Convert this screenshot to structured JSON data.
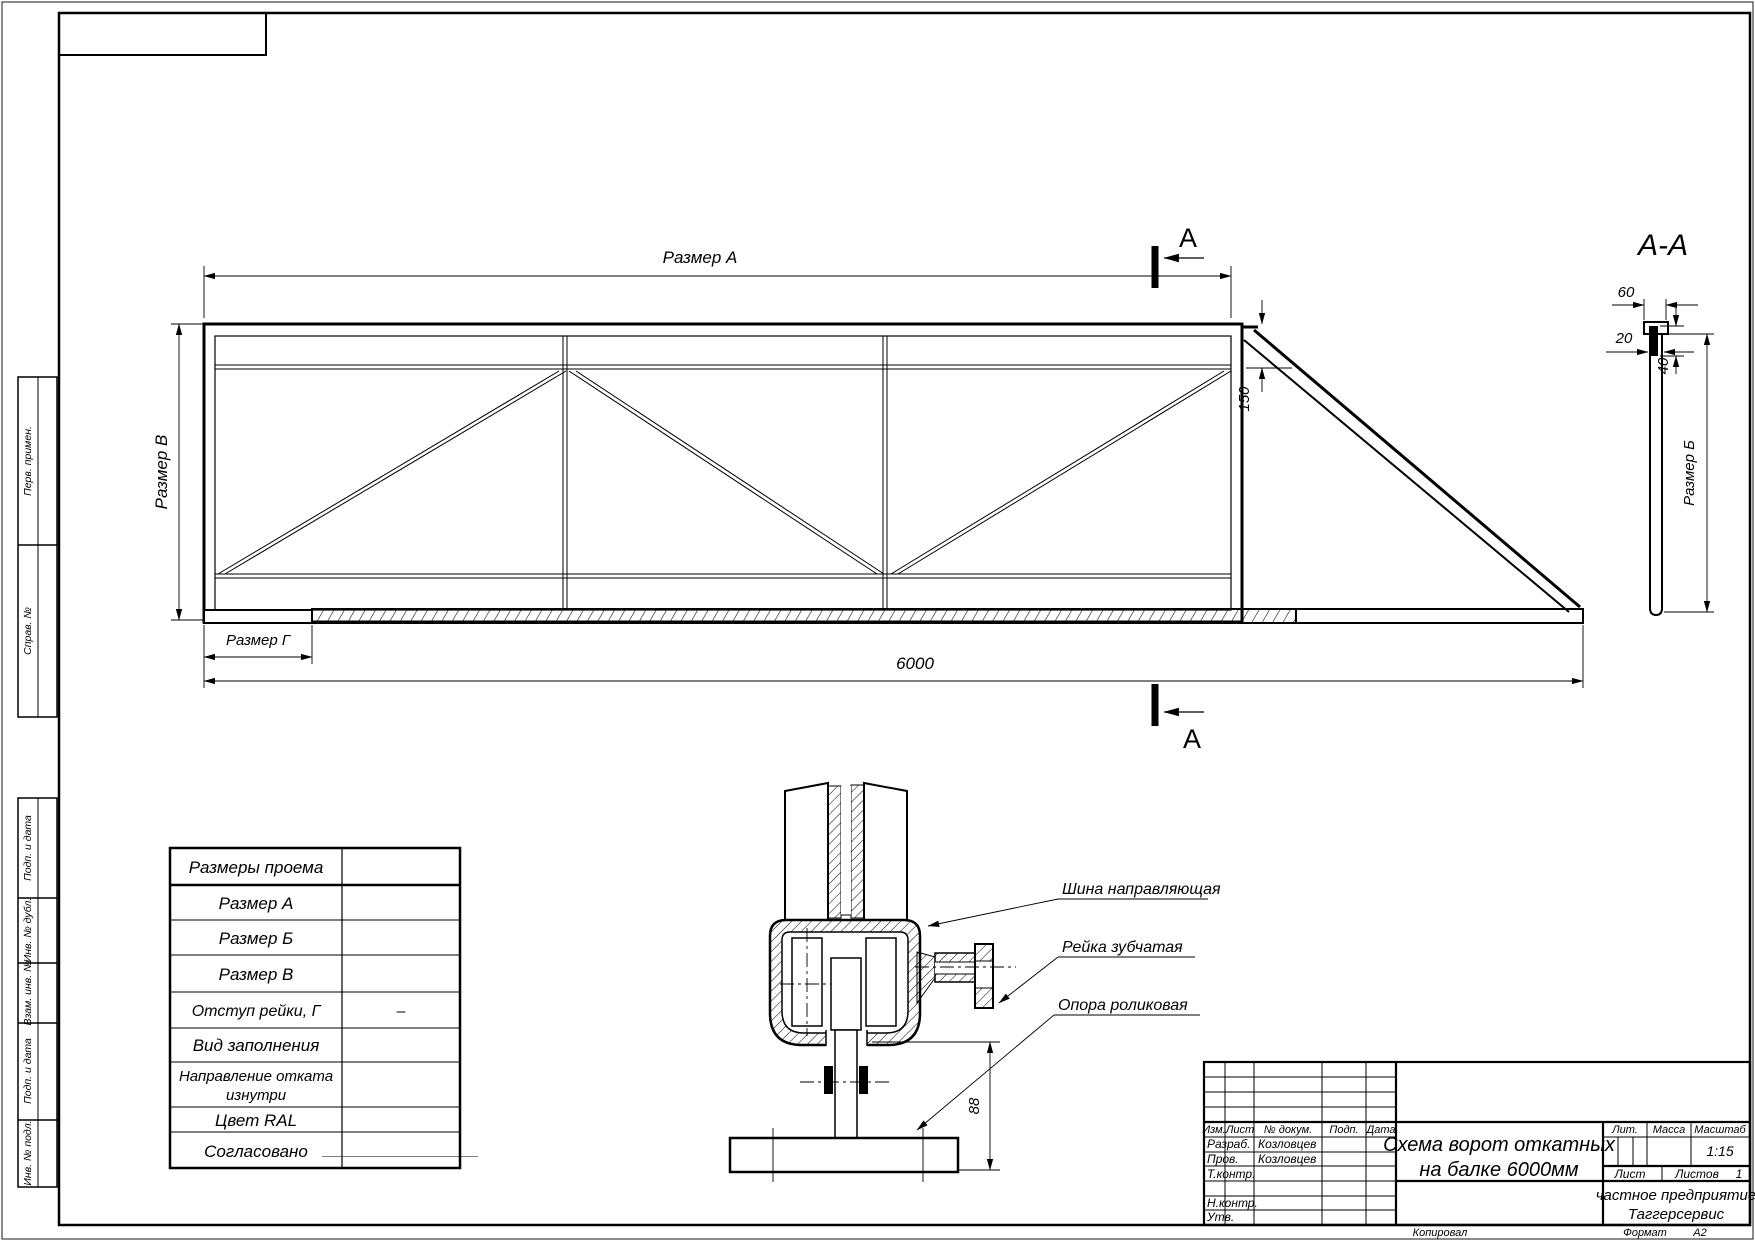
{
  "gate_view": {
    "dim_a": "Размер А",
    "dim_v": "Размер В",
    "dim_g": "Размер Г",
    "dim_length": "6000",
    "dim_150": "150",
    "section_letter": "А",
    "section_letter_bottom": "А"
  },
  "section_view": {
    "title": "А-А",
    "dim_60": "60",
    "dim_20": "20",
    "dim_40": "40",
    "dim_b": "Размер Б"
  },
  "detail_view": {
    "label_shina": "Шина направляющая",
    "label_reika": "Рейка зубчатая",
    "label_opora": "Опора роликовая",
    "dim_88": "88"
  },
  "spec_table": {
    "rows": [
      {
        "label": "Размеры проема",
        "value": ""
      },
      {
        "label": "Размер А",
        "value": ""
      },
      {
        "label": "Размер Б",
        "value": ""
      },
      {
        "label": "Размер В",
        "value": ""
      },
      {
        "label": "Отступ рейки, Г",
        "value": "–"
      },
      {
        "label": "Вид заполнения",
        "value": ""
      },
      {
        "label": "Направление отката",
        "label_line2": "изнутри",
        "value": ""
      },
      {
        "label": "Цвет RAL",
        "value": ""
      },
      {
        "label": "Согласовано",
        "value": "____________________"
      }
    ]
  },
  "title_block": {
    "cols": {
      "izm": "Изм.",
      "list": "Лист",
      "doc": "№ докум.",
      "podp": "Подп.",
      "data": "Дата"
    },
    "roles": {
      "razrab": "Разраб.",
      "prov": "Пров.",
      "tkontr": "Т.контр.",
      "nkontr": "Н.контр.",
      "utv": "Утв."
    },
    "names": {
      "razrab": "Козловцев",
      "prov": "Козловцев"
    },
    "title_line1": "Схема ворот откатных",
    "title_line2": "на балке 6000мм",
    "lit": "Лит.",
    "massa": "Масса",
    "masshtab": "Масштаб",
    "scale": "1:15",
    "sheet": "Лист",
    "sheets": "Листов",
    "sheets_count": "1",
    "org_line1": "частное предприятие",
    "org_line2": "Таггерсервис",
    "copied": "Копировал",
    "format": "Формат",
    "format_value": "А2"
  },
  "side_panel": {
    "items": [
      {
        "label": "Перв. примен."
      },
      {
        "label": "Справ. №"
      },
      {
        "label": "Подп. и дата"
      },
      {
        "label": "Инв. № дубл."
      },
      {
        "label": "Взам. инв. №"
      },
      {
        "label": "Подп. и дата"
      },
      {
        "label": "Инв. № подл."
      }
    ]
  }
}
